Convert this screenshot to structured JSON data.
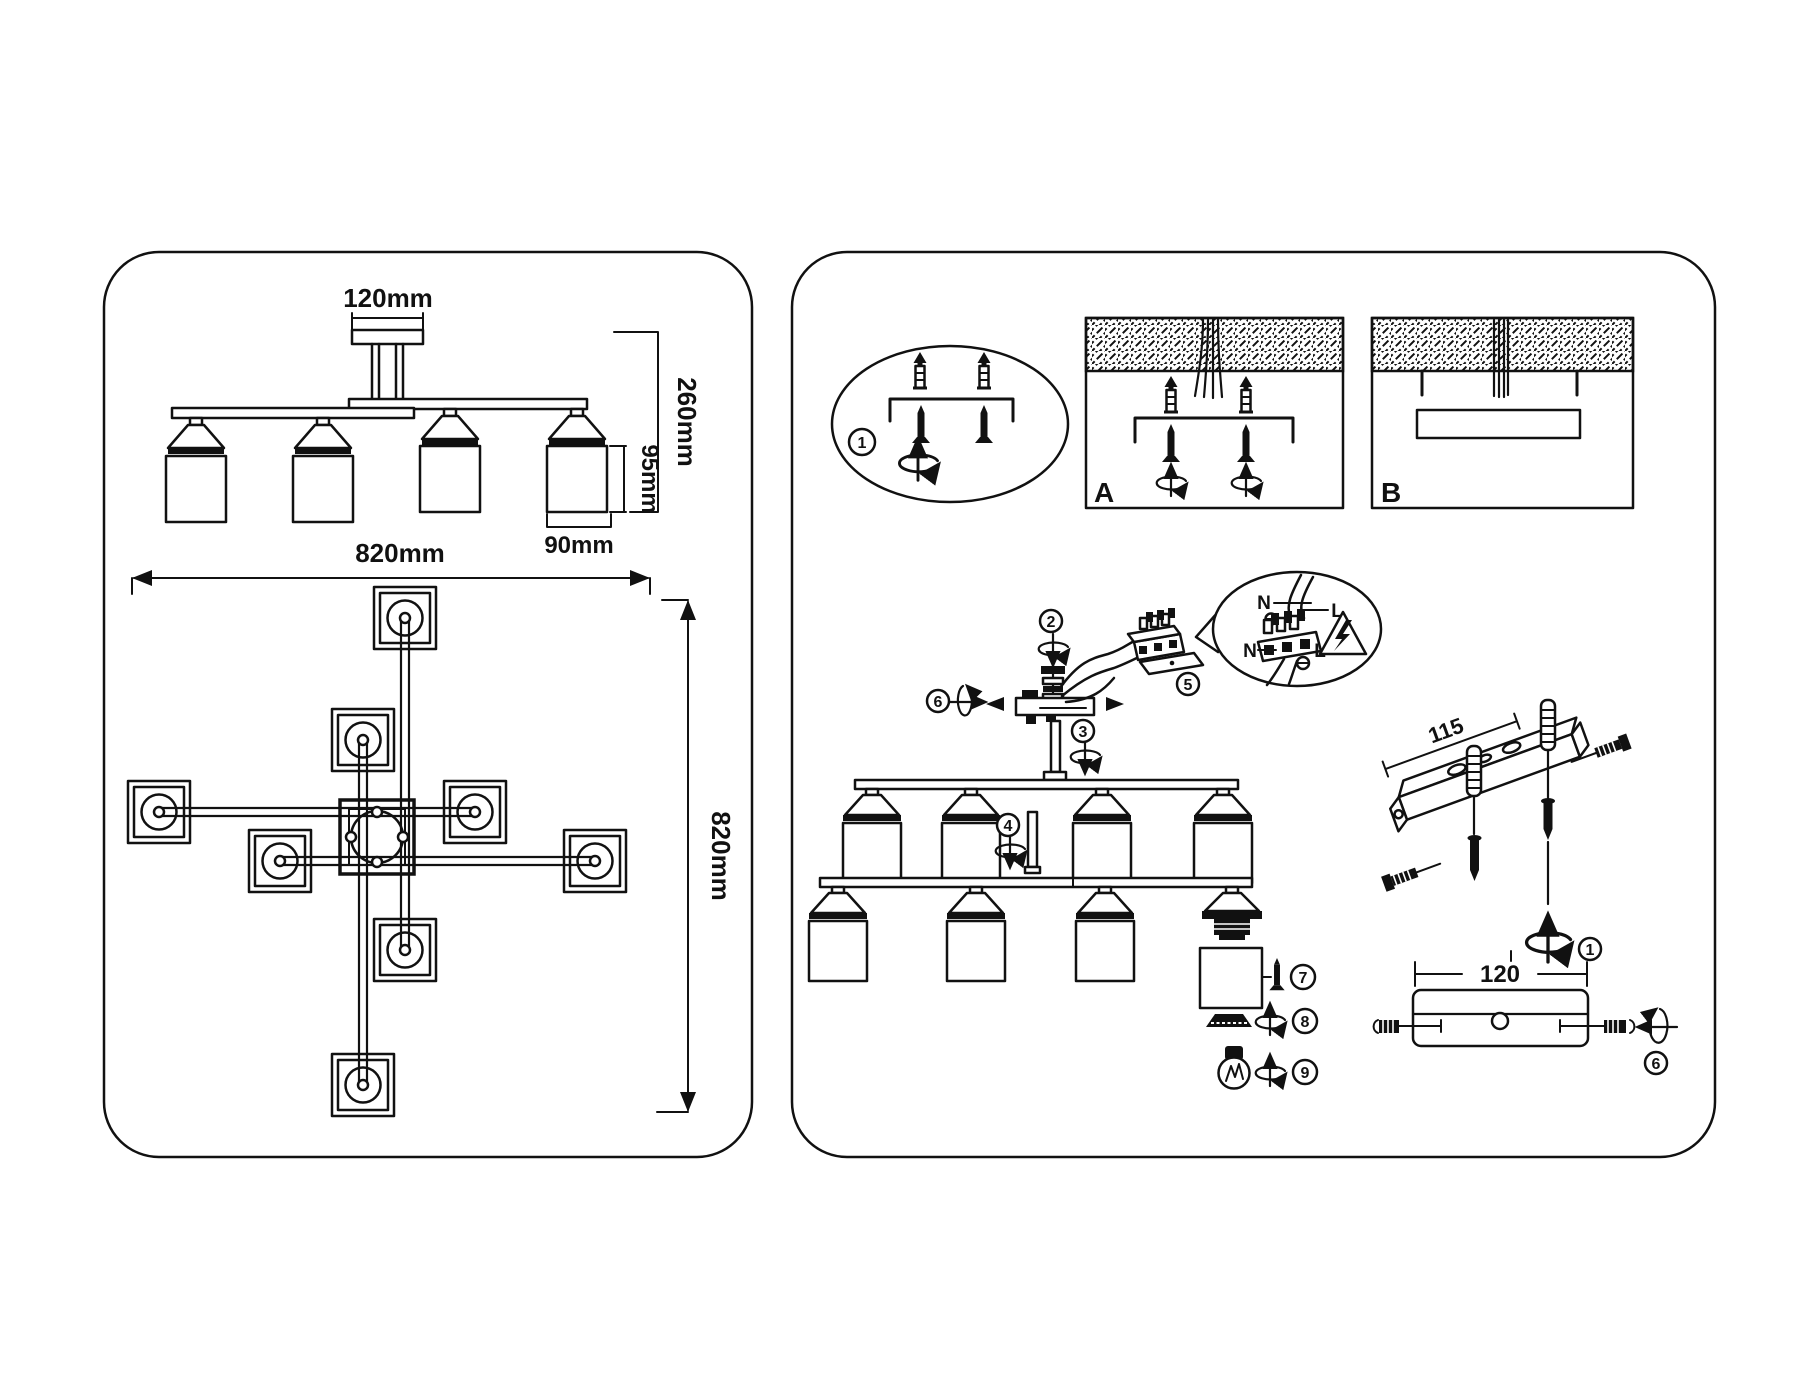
{
  "document": {
    "type": "luminaire installation instruction sheet"
  },
  "colors": {
    "ink": "#111111",
    "background": "#ffffff"
  },
  "left_panel": {
    "side_view": {
      "canopy_width_label": "120mm",
      "overall_height_label": "260mm",
      "shade_height_label": "95mm",
      "shade_width_label": "90mm"
    },
    "top_view": {
      "width_label": "820mm",
      "depth_label": "820mm"
    }
  },
  "right_panel": {
    "step_markers": {
      "s1": "1",
      "s2": "2",
      "s3": "3",
      "s4": "4",
      "s5": "5",
      "s6": "6",
      "s7": "7",
      "s8": "8",
      "s9": "9"
    },
    "mount_options": {
      "a_label": "A",
      "b_label": "B"
    },
    "wiring_detail": {
      "neutral_top": "N",
      "live_top": "L",
      "neutral_bottom": "N",
      "live_bottom": "L"
    },
    "bracket_detail": {
      "length_label": "115"
    },
    "canopy_detail": {
      "width_label": "120"
    }
  }
}
